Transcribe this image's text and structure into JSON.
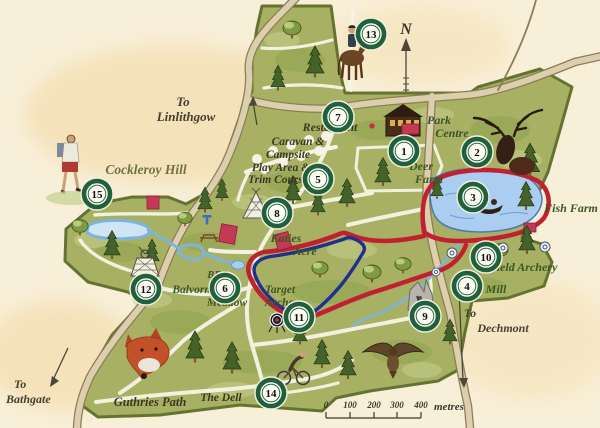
{
  "map": {
    "compass_label": "N",
    "signs": {
      "linlithgow": [
        "To",
        "Linlithgow"
      ],
      "bathgate": [
        "To",
        "Bathgate"
      ],
      "dechmont": [
        "To",
        "Dechmont"
      ]
    },
    "places": {
      "cockleroy_hill": "Cockleroy Hill",
      "restaurant": "Restaurant",
      "caravan_campsite": [
        "Caravan &",
        "Campsite"
      ],
      "play_area": [
        "Play Area &",
        "Trim Course"
      ],
      "park_centre": [
        "Park",
        "Centre"
      ],
      "deer_farm": [
        "Deer",
        "Farm"
      ],
      "fish_farm": "Fish Farm",
      "katies_acre": [
        "Katies",
        "Acre"
      ],
      "bbq": "BBQ",
      "balvormie_meadow": [
        "Balvormie",
        "Meadow"
      ],
      "target_archery": [
        "Target",
        "Archery"
      ],
      "field_archery": "Field Archery",
      "mill": "Mill",
      "guthries_path": "Guthries Path",
      "the_dell": "The Dell"
    },
    "markers": [
      "1",
      "2",
      "3",
      "4",
      "5",
      "6",
      "7",
      "8",
      "9",
      "10",
      "11",
      "12",
      "13",
      "14",
      "15"
    ],
    "scale_bar": {
      "ticks": [
        "0",
        "100",
        "200",
        "300",
        "400"
      ],
      "unit": "metres"
    },
    "colors": {
      "background": "#f8efd8",
      "park_green": "#a8b163",
      "trail_red": "#c02030",
      "trail_blue": "#20308e",
      "water_blue": "#a9cdf0",
      "marker_green": "#20603c"
    }
  }
}
